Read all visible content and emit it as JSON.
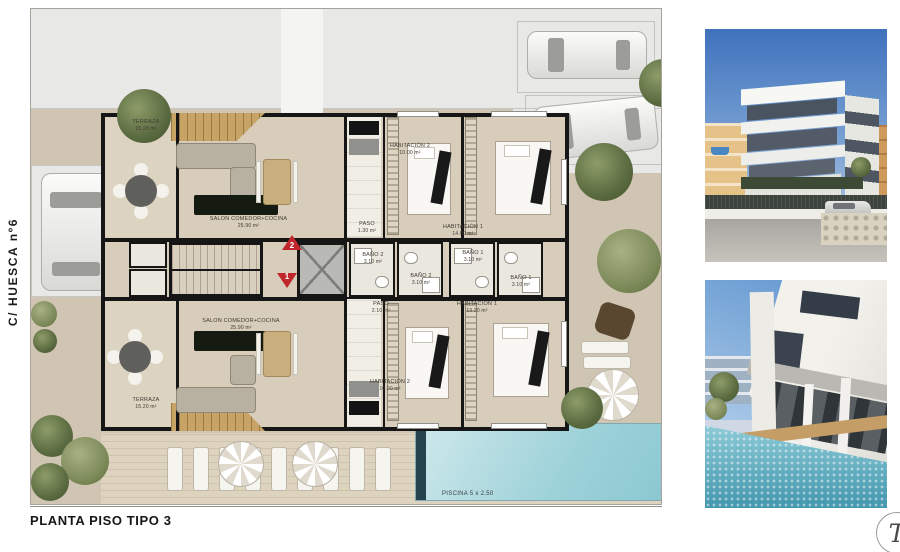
{
  "sidebar": {
    "street_label": "C/ HUESCA nº6"
  },
  "footer": {
    "title": "PLANTA PISO TIPO 3",
    "logo_letter": "T"
  },
  "plan": {
    "stair_markers": {
      "upper_number": "2",
      "lower_number": "1"
    },
    "pool": {
      "label": "PISCINA 5 x 2.50"
    },
    "apartment_top": {
      "terraza": {
        "name": "TERRAZA",
        "area": "15.20 m²"
      },
      "salon": {
        "name": "SALON COMEDOR+COCINA",
        "area": "25.90 m²"
      },
      "paso": {
        "name": "PASO",
        "area": "1.30 m²"
      },
      "hab2": {
        "name": "HABITACIÓN 2",
        "area": "10.00 m²"
      },
      "hab1": {
        "name": "HABITACIÓN 1",
        "area": "14.00 m²"
      },
      "bano2": {
        "name": "BAÑO 2",
        "area": "3.10 m²"
      },
      "bano1": {
        "name": "BAÑO 1",
        "area": "3.10 m²"
      }
    },
    "apartment_bottom": {
      "terraza": {
        "name": "TERRAZA",
        "area": "15.20 m²"
      },
      "salon": {
        "name": "SALON COMEDOR+COCINA",
        "area": "25.90 m²"
      },
      "paso": {
        "name": "PASO",
        "area": "2.10 m²"
      },
      "hab2": {
        "name": "HABITACIÓN 2",
        "area": "10.00 m²"
      },
      "hab1": {
        "name": "HABITACIÓN 1",
        "area": "13.20 m²"
      },
      "bano2": {
        "name": "BAÑO 2",
        "area": "3.10 m²"
      },
      "bano1": {
        "name": "BAÑO 1",
        "area": "3.10 m²"
      }
    }
  },
  "colors": {
    "marker_red": "#c0272d",
    "pool_blue": "#9ed2d9",
    "ground_beige": "#cfc5b2",
    "street_gray": "#e8e8e6"
  }
}
